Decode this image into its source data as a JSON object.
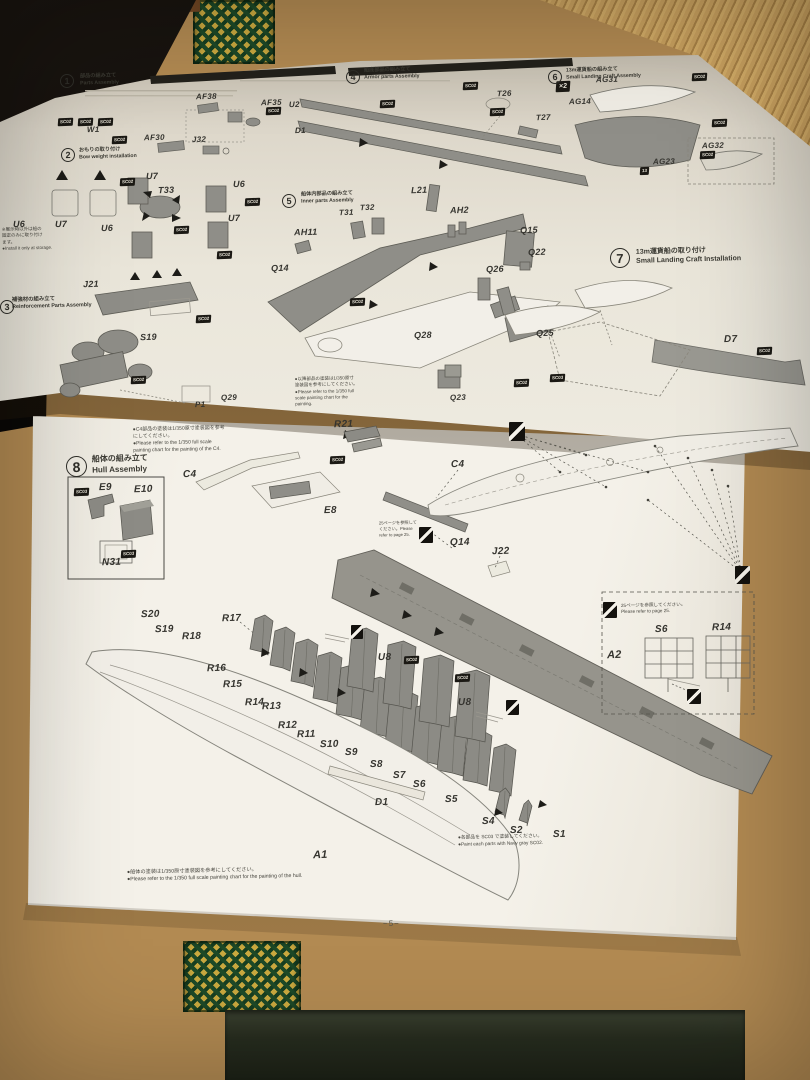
{
  "scene": {
    "colors": {
      "tatami": "#b28a52",
      "tatami_light": "#c9a15f",
      "border_green": "#1e4a28",
      "border_gold": "#caa93f",
      "paper": "#f1eee5",
      "print_gray": "#8f8e88",
      "ink": "#2f2e29",
      "shadow": "#0a0806"
    }
  },
  "footer": {
    "page_number": "−5−"
  },
  "steps": [
    {
      "num": "1",
      "x": 60,
      "y": 74,
      "r": 14,
      "fs": 9,
      "tx": 80,
      "ty": 72,
      "tw": 110,
      "tfs": 5.2,
      "title_jp": "部品の組み立て",
      "title_en": "Parts Assembly"
    },
    {
      "num": "2",
      "x": 61,
      "y": 148,
      "r": 14,
      "fs": 9,
      "tx": 79,
      "ty": 146,
      "tw": 110,
      "tfs": 5.2,
      "title_jp": "おもりの取り付け",
      "title_en": "Bow weight installation"
    },
    {
      "num": "3",
      "x": 0,
      "y": 300,
      "r": 14,
      "fs": 9,
      "tx": 12,
      "ty": 296,
      "tw": 86,
      "tfs": 5.4,
      "title_jp": "補強材の組み立て",
      "title_en": "Reinforcement Parts Assembly"
    },
    {
      "num": "4",
      "x": 346,
      "y": 70,
      "r": 14,
      "fs": 9,
      "tx": 364,
      "ty": 66,
      "tw": 120,
      "tfs": 5.2,
      "title_jp": "船底部品の組み立て",
      "title_en": "Armor parts Assembly"
    },
    {
      "num": "5",
      "x": 282,
      "y": 194,
      "r": 14,
      "fs": 9,
      "tx": 301,
      "ty": 190,
      "tw": 120,
      "tfs": 5.2,
      "title_jp": "船体内部品の組み立て",
      "title_en": "Inner parts Assembly"
    },
    {
      "num": "6",
      "x": 548,
      "y": 70,
      "r": 14,
      "fs": 9,
      "tx": 566,
      "ty": 66,
      "tw": 120,
      "tfs": 5.2,
      "title_jp": "13m運貨船の組み立て",
      "title_en": "Small Landing Craft Assembly"
    },
    {
      "num": "7",
      "x": 610,
      "y": 248,
      "r": 20,
      "fs": 13,
      "tx": 636,
      "ty": 246,
      "tw": 140,
      "tfs": 7,
      "title_jp": "13m運貨船の取り付け",
      "title_en": "Small Landing Craft Installation"
    },
    {
      "num": "8",
      "x": 66,
      "y": 456,
      "r": 21,
      "fs": 14,
      "tx": 92,
      "ty": 453,
      "tw": 120,
      "tfs": 8,
      "title_jp": "船体の組み立て",
      "title_en": "Hull Assembly"
    }
  ],
  "part_labels": [
    {
      "t": "AF38",
      "x": 196,
      "y": 93,
      "s": 8
    },
    {
      "t": "AF35",
      "x": 261,
      "y": 99,
      "s": 8
    },
    {
      "t": "W1",
      "x": 87,
      "y": 126,
      "s": 8
    },
    {
      "t": "AF30",
      "x": 144,
      "y": 134,
      "s": 8
    },
    {
      "t": "J32",
      "x": 192,
      "y": 136,
      "s": 8
    },
    {
      "t": "U2",
      "x": 289,
      "y": 101,
      "s": 8
    },
    {
      "t": "D1",
      "x": 295,
      "y": 127,
      "s": 8
    },
    {
      "t": "T26",
      "x": 497,
      "y": 90,
      "s": 8
    },
    {
      "t": "T27",
      "x": 536,
      "y": 114,
      "s": 8
    },
    {
      "t": "U6",
      "x": 13,
      "y": 220,
      "s": 9
    },
    {
      "t": "U7",
      "x": 55,
      "y": 220,
      "s": 9
    },
    {
      "t": "U7",
      "x": 146,
      "y": 172,
      "s": 9
    },
    {
      "t": "T33",
      "x": 158,
      "y": 186,
      "s": 9
    },
    {
      "t": "U6",
      "x": 233,
      "y": 180,
      "s": 9
    },
    {
      "t": "U6",
      "x": 101,
      "y": 224,
      "s": 9
    },
    {
      "t": "U7",
      "x": 228,
      "y": 214,
      "s": 9
    },
    {
      "t": "J21",
      "x": 83,
      "y": 280,
      "s": 9
    },
    {
      "t": "S19",
      "x": 140,
      "y": 333,
      "s": 9
    },
    {
      "t": "P1",
      "x": 195,
      "y": 401,
      "s": 8
    },
    {
      "t": "Q29",
      "x": 221,
      "y": 394,
      "s": 8
    },
    {
      "t": "L21",
      "x": 411,
      "y": 186,
      "s": 9
    },
    {
      "t": "T31",
      "x": 339,
      "y": 209,
      "s": 8
    },
    {
      "t": "T32",
      "x": 360,
      "y": 204,
      "s": 8
    },
    {
      "t": "AH2",
      "x": 450,
      "y": 206,
      "s": 9
    },
    {
      "t": "AH11",
      "x": 294,
      "y": 228,
      "s": 9
    },
    {
      "t": "Q14",
      "x": 271,
      "y": 264,
      "s": 9
    },
    {
      "t": "Q15",
      "x": 520,
      "y": 226,
      "s": 9
    },
    {
      "t": "Q22",
      "x": 528,
      "y": 248,
      "s": 9
    },
    {
      "t": "Q26",
      "x": 486,
      "y": 265,
      "s": 9
    },
    {
      "t": "Q25",
      "x": 536,
      "y": 329,
      "s": 9
    },
    {
      "t": "Q28",
      "x": 414,
      "y": 331,
      "s": 9
    },
    {
      "t": "Q23",
      "x": 450,
      "y": 394,
      "s": 8
    },
    {
      "t": "D7",
      "x": 724,
      "y": 335,
      "s": 10
    },
    {
      "t": "AG31",
      "x": 596,
      "y": 76,
      "s": 8
    },
    {
      "t": "AG14",
      "x": 569,
      "y": 98,
      "s": 8
    },
    {
      "t": "AG23",
      "x": 653,
      "y": 158,
      "s": 8
    },
    {
      "t": "AG32",
      "x": 702,
      "y": 142,
      "s": 8
    },
    {
      "t": "R21",
      "x": 334,
      "y": 420,
      "s": 10
    },
    {
      "t": "C4",
      "x": 183,
      "y": 470,
      "s": 10
    },
    {
      "t": "C4",
      "x": 451,
      "y": 460,
      "s": 10
    },
    {
      "t": "E9",
      "x": 99,
      "y": 483,
      "s": 10
    },
    {
      "t": "E10",
      "x": 134,
      "y": 485,
      "s": 10
    },
    {
      "t": "N31",
      "x": 102,
      "y": 558,
      "s": 10
    },
    {
      "t": "E8",
      "x": 324,
      "y": 506,
      "s": 10
    },
    {
      "t": "Q14",
      "x": 450,
      "y": 538,
      "s": 10
    },
    {
      "t": "J22",
      "x": 492,
      "y": 547,
      "s": 10
    },
    {
      "t": "S20",
      "x": 141,
      "y": 610,
      "s": 10
    },
    {
      "t": "S19",
      "x": 155,
      "y": 625,
      "s": 10
    },
    {
      "t": "R17",
      "x": 222,
      "y": 614,
      "s": 10
    },
    {
      "t": "R18",
      "x": 182,
      "y": 632,
      "s": 10
    },
    {
      "t": "R16",
      "x": 207,
      "y": 664,
      "s": 10
    },
    {
      "t": "R15",
      "x": 223,
      "y": 680,
      "s": 10
    },
    {
      "t": "R14",
      "x": 245,
      "y": 698,
      "s": 10
    },
    {
      "t": "R13",
      "x": 262,
      "y": 702,
      "s": 10
    },
    {
      "t": "R12",
      "x": 278,
      "y": 721,
      "s": 10
    },
    {
      "t": "R11",
      "x": 297,
      "y": 730,
      "s": 10
    },
    {
      "t": "S10",
      "x": 320,
      "y": 740,
      "s": 10
    },
    {
      "t": "S9",
      "x": 345,
      "y": 748,
      "s": 10
    },
    {
      "t": "S8",
      "x": 370,
      "y": 760,
      "s": 10
    },
    {
      "t": "S7",
      "x": 393,
      "y": 771,
      "s": 10
    },
    {
      "t": "S6",
      "x": 413,
      "y": 780,
      "s": 10
    },
    {
      "t": "S5",
      "x": 445,
      "y": 795,
      "s": 10
    },
    {
      "t": "D1",
      "x": 375,
      "y": 798,
      "s": 10
    },
    {
      "t": "S4",
      "x": 482,
      "y": 817,
      "s": 10
    },
    {
      "t": "S2",
      "x": 510,
      "y": 826,
      "s": 10
    },
    {
      "t": "S1",
      "x": 553,
      "y": 830,
      "s": 10
    },
    {
      "t": "U8",
      "x": 378,
      "y": 653,
      "s": 10
    },
    {
      "t": "U8",
      "x": 458,
      "y": 698,
      "s": 10
    },
    {
      "t": "A2",
      "x": 607,
      "y": 650,
      "s": 11
    },
    {
      "t": "S6",
      "x": 655,
      "y": 625,
      "s": 10
    },
    {
      "t": "R14",
      "x": 712,
      "y": 623,
      "s": 10
    },
    {
      "t": "A1",
      "x": 313,
      "y": 850,
      "s": 11
    }
  ],
  "badges": [
    {
      "t": "SC02",
      "x": 266,
      "y": 107
    },
    {
      "t": "SC02",
      "x": 58,
      "y": 118
    },
    {
      "t": "SC02",
      "x": 78,
      "y": 118
    },
    {
      "t": "SC02",
      "x": 98,
      "y": 118
    },
    {
      "t": "SC02",
      "x": 112,
      "y": 136
    },
    {
      "t": "SC02",
      "x": 120,
      "y": 178
    },
    {
      "t": "SC02",
      "x": 174,
      "y": 226
    },
    {
      "t": "SC02",
      "x": 245,
      "y": 198
    },
    {
      "t": "SC02",
      "x": 217,
      "y": 251
    },
    {
      "t": "SC02",
      "x": 196,
      "y": 315
    },
    {
      "t": "SC02",
      "x": 131,
      "y": 376
    },
    {
      "t": "SC02",
      "x": 463,
      "y": 82
    },
    {
      "t": "SC02",
      "x": 380,
      "y": 100
    },
    {
      "t": "SC02",
      "x": 490,
      "y": 108
    },
    {
      "t": "SC02",
      "x": 350,
      "y": 298
    },
    {
      "t": "SC02",
      "x": 692,
      "y": 73
    },
    {
      "t": "SC02",
      "x": 712,
      "y": 119
    },
    {
      "t": "SC02",
      "x": 700,
      "y": 151
    },
    {
      "t": "13",
      "x": 640,
      "y": 167
    },
    {
      "t": "SC02",
      "x": 757,
      "y": 347
    },
    {
      "t": "SC02",
      "x": 514,
      "y": 379
    },
    {
      "t": "SC03",
      "x": 550,
      "y": 374
    },
    {
      "t": "SC02",
      "x": 330,
      "y": 456
    },
    {
      "t": "SC03",
      "x": 74,
      "y": 488
    },
    {
      "t": "SC03",
      "x": 121,
      "y": 550
    },
    {
      "t": "SC02",
      "x": 404,
      "y": 656
    },
    {
      "t": "SC02",
      "x": 455,
      "y": 674
    },
    {
      "t": "×2",
      "x": 556,
      "y": 81,
      "big": true
    }
  ],
  "markers": [
    {
      "x": 509,
      "y": 422,
      "w": 16,
      "h": 19
    },
    {
      "x": 735,
      "y": 566,
      "w": 15,
      "h": 18
    },
    {
      "x": 419,
      "y": 527,
      "w": 14,
      "h": 16
    },
    {
      "x": 603,
      "y": 602,
      "w": 14,
      "h": 16
    },
    {
      "x": 687,
      "y": 689,
      "w": 14,
      "h": 15
    },
    {
      "x": 351,
      "y": 625,
      "w": 12,
      "h": 14
    },
    {
      "x": 506,
      "y": 700,
      "w": 13,
      "h": 15
    }
  ],
  "notes": [
    {
      "id": "step2-note",
      "x": 2,
      "y": 226,
      "w": 80,
      "fs": 4.5,
      "lines": [
        "※展示時以外は船の",
        "固定のみに取り付け",
        "ます。",
        "●Install it only at storage."
      ]
    },
    {
      "id": "step5-note",
      "x": 295,
      "y": 375,
      "w": 132,
      "fs": 4.5,
      "lines": [
        "●以降部品の塗装は1/350原寸",
        "塗装図を参考にしてください。",
        "●Please refer to the 1/350 full",
        "scale painting chart for the",
        "painting."
      ]
    },
    {
      "id": "step8-top-note",
      "x": 133,
      "y": 425,
      "w": 162,
      "fs": 5,
      "lines": [
        "●C4部品の塗装は1/350原寸塗装図を参考",
        "にしてください。",
        "●Please refer to the 1/350 full scale",
        "painting chart for the painting of the C4."
      ]
    },
    {
      "id": "page25-left-note",
      "x": 379,
      "y": 520,
      "w": 46,
      "fs": 4.2,
      "lines": [
        "25ページを参照して",
        "ください。Please",
        "refer to page 25."
      ]
    },
    {
      "id": "page25-right-note",
      "x": 621,
      "y": 602,
      "w": 96,
      "fs": 4.6,
      "lines": [
        "25ページを参照してください。",
        "Please refer to page 25."
      ]
    },
    {
      "id": "paint-each-note",
      "x": 458,
      "y": 834,
      "w": 168,
      "fs": 4.8,
      "lines": [
        "●各部品を SC03 で塗装してください。",
        "●Paint each parts with Navy gray SC02."
      ]
    },
    {
      "id": "hull-bottom-note",
      "x": 127,
      "y": 867,
      "w": 242,
      "fs": 5.2,
      "lines": [
        "●船体の塗装は1/350原寸塗装図を参考にしてください。",
        "●Please refer to the 1/350 full scale painting chart for the painting of the hull."
      ]
    }
  ]
}
